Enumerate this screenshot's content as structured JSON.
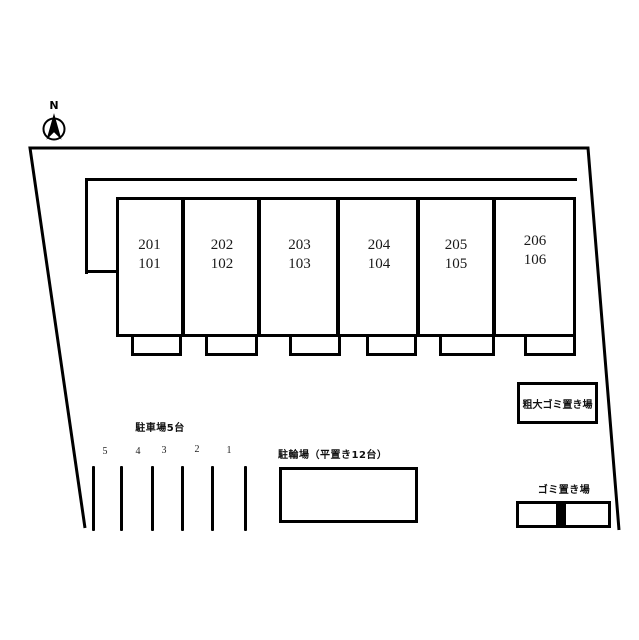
{
  "compass": {
    "label": "N"
  },
  "building": {
    "units": [
      {
        "upper": "201",
        "lower": "101"
      },
      {
        "upper": "202",
        "lower": "102"
      },
      {
        "upper": "203",
        "lower": "103"
      },
      {
        "upper": "204",
        "lower": "104"
      },
      {
        "upper": "205",
        "lower": "105"
      },
      {
        "upper": "206",
        "lower": "106"
      }
    ]
  },
  "parking": {
    "label": "駐車場5台",
    "spaces": [
      "5",
      "4",
      "3",
      "2",
      "1"
    ]
  },
  "bicycle": {
    "label": "駐輪場（平置き12台）"
  },
  "bulky_garbage": {
    "label": "粗大ゴミ置き場"
  },
  "garbage": {
    "label": "ゴミ置き場"
  },
  "colors": {
    "line": "#000000",
    "background": "#ffffff"
  }
}
